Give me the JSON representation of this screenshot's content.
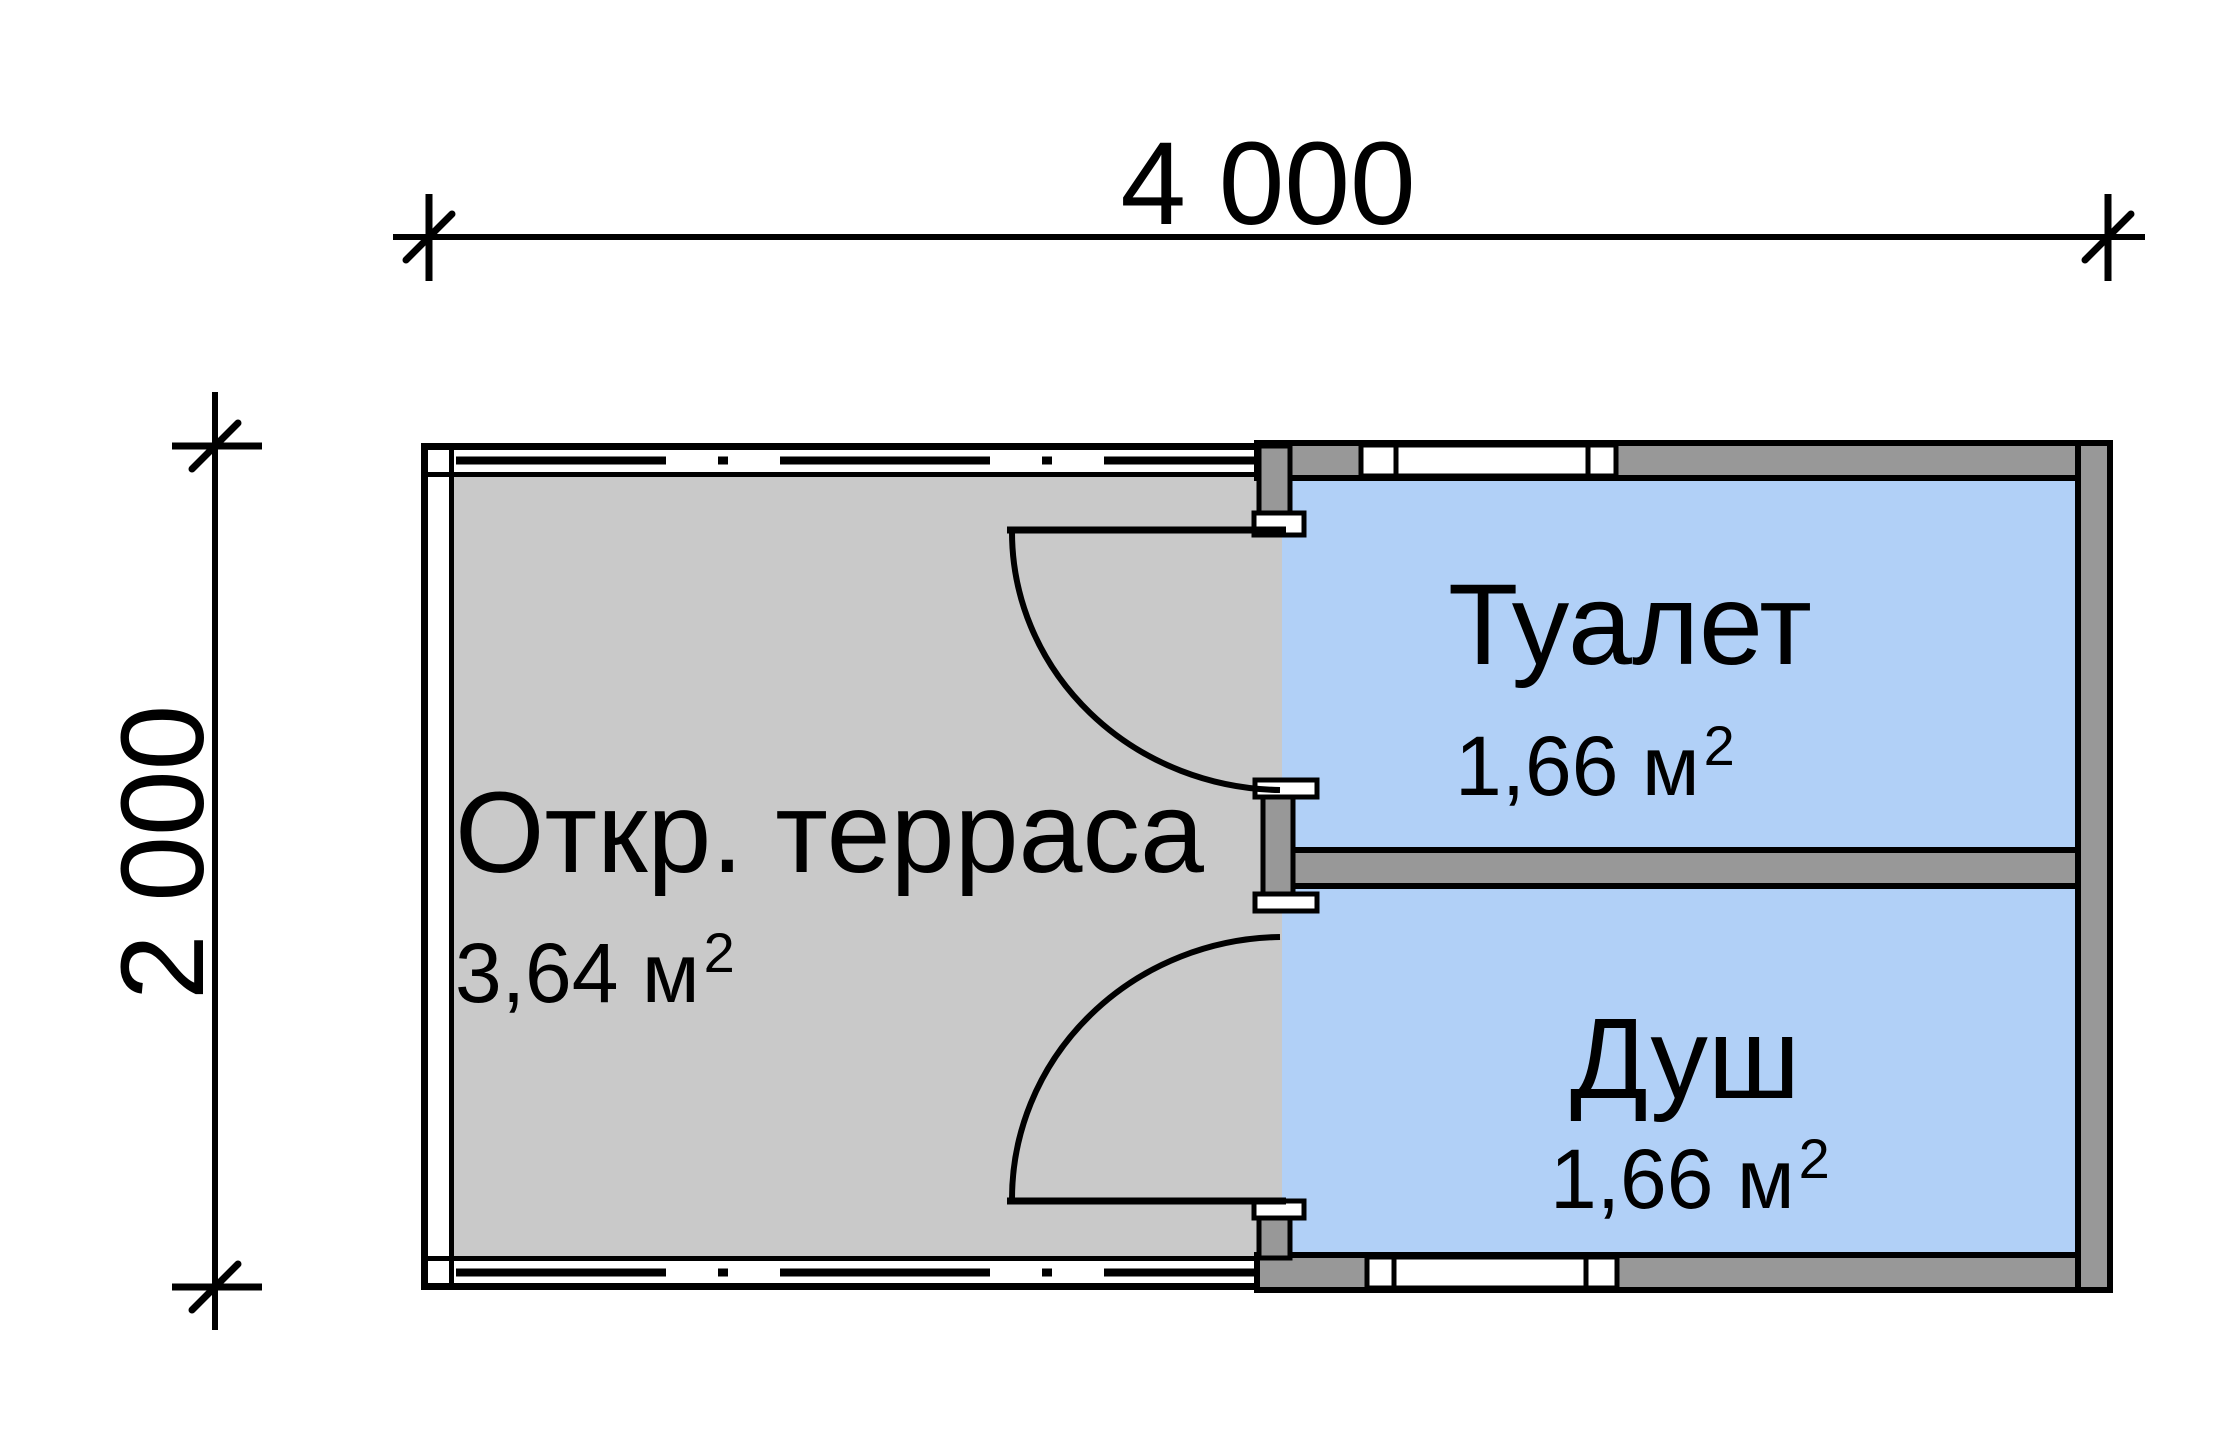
{
  "dimensions": {
    "width_label": "4 000",
    "height_label": "2 000"
  },
  "rooms": {
    "terrace": {
      "name": "Откр. терраса",
      "area": "3,64 м",
      "area_sup": "2"
    },
    "toilet": {
      "name": "Туалет",
      "area": "1,66 м",
      "area_sup": "2"
    },
    "shower": {
      "name": "Душ",
      "area": "1,66 м",
      "area_sup": "2"
    }
  },
  "colors": {
    "terrace_fill": "#c9c9c9",
    "wall_fill": "#989898",
    "room_fill": "#b1d0f7",
    "window_fill": "#ffffff",
    "line": "#000000"
  }
}
